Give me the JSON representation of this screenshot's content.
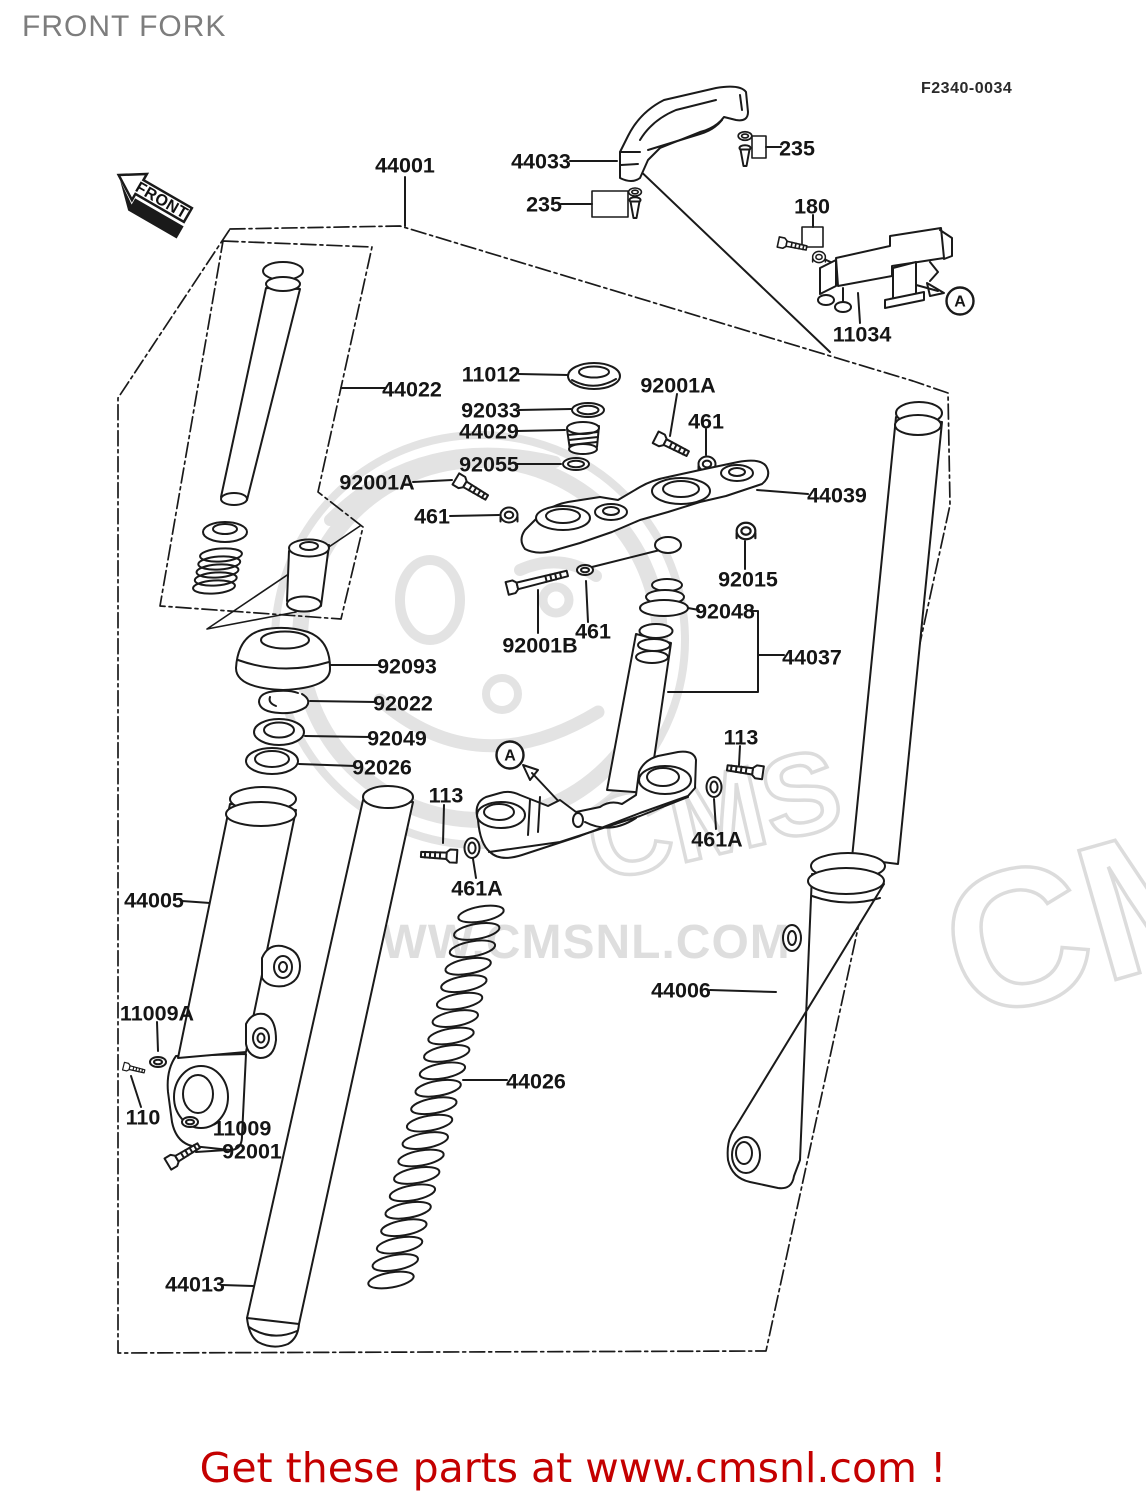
{
  "header": {
    "title": "FRONT FORK",
    "diagram_code": "F2340-0034"
  },
  "footer": {
    "text": "Get these parts at www.cmsnl.com !"
  },
  "watermark": {
    "brand": "CMS",
    "brand_large": "CMS",
    "url_text": "WWW.CMSNL.COM"
  },
  "front_arrow": {
    "label": "FRONT"
  },
  "ref_markers": [
    {
      "id": "ref-a-upper",
      "text": "A",
      "x": 960,
      "y": 301
    },
    {
      "id": "ref-a-lower",
      "text": "A",
      "x": 510,
      "y": 755
    }
  ],
  "part_labels": [
    {
      "part": "44001",
      "x": 405,
      "y": 165
    },
    {
      "part": "44033",
      "x": 541,
      "y": 161
    },
    {
      "part": "235",
      "x": 797,
      "y": 148
    },
    {
      "part": "235",
      "x": 544,
      "y": 204
    },
    {
      "part": "180",
      "x": 812,
      "y": 206
    },
    {
      "part": "11034",
      "x": 862,
      "y": 334
    },
    {
      "part": "44022",
      "x": 412,
      "y": 389
    },
    {
      "part": "11012",
      "x": 491,
      "y": 374
    },
    {
      "part": "92033",
      "x": 491,
      "y": 410
    },
    {
      "part": "44029",
      "x": 489,
      "y": 431
    },
    {
      "part": "92055",
      "x": 489,
      "y": 464
    },
    {
      "part": "92001A",
      "x": 678,
      "y": 385
    },
    {
      "part": "461",
      "x": 706,
      "y": 421
    },
    {
      "part": "92001A",
      "x": 377,
      "y": 482
    },
    {
      "part": "461",
      "x": 432,
      "y": 516
    },
    {
      "part": "44039",
      "x": 837,
      "y": 495
    },
    {
      "part": "92015",
      "x": 748,
      "y": 579
    },
    {
      "part": "92048",
      "x": 725,
      "y": 611
    },
    {
      "part": "44037",
      "x": 812,
      "y": 657
    },
    {
      "part": "461",
      "x": 593,
      "y": 631
    },
    {
      "part": "92001B",
      "x": 540,
      "y": 645
    },
    {
      "part": "92093",
      "x": 407,
      "y": 666
    },
    {
      "part": "92022",
      "x": 403,
      "y": 703
    },
    {
      "part": "92049",
      "x": 397,
      "y": 738
    },
    {
      "part": "92026",
      "x": 382,
      "y": 767
    },
    {
      "part": "113",
      "x": 446,
      "y": 795
    },
    {
      "part": "461A",
      "x": 477,
      "y": 888
    },
    {
      "part": "113",
      "x": 741,
      "y": 737
    },
    {
      "part": "461A",
      "x": 717,
      "y": 839
    },
    {
      "part": "44005",
      "x": 154,
      "y": 900
    },
    {
      "part": "11009A",
      "x": 157,
      "y": 1013
    },
    {
      "part": "110",
      "x": 143,
      "y": 1117
    },
    {
      "part": "11009",
      "x": 242,
      "y": 1128
    },
    {
      "part": "92001",
      "x": 252,
      "y": 1151
    },
    {
      "part": "44013",
      "x": 195,
      "y": 1284
    },
    {
      "part": "44026",
      "x": 536,
      "y": 1081
    },
    {
      "part": "44006",
      "x": 681,
      "y": 990
    }
  ]
}
